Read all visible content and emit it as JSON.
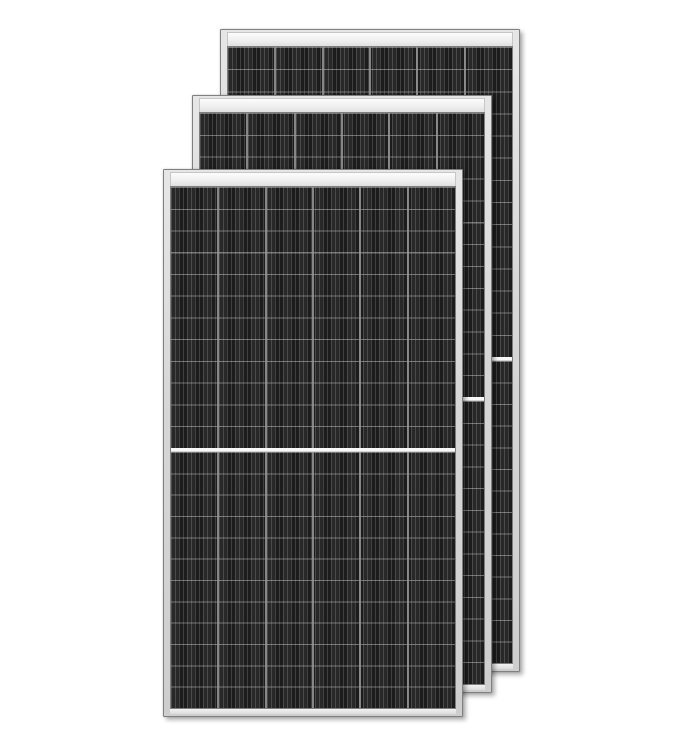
{
  "image": {
    "type": "product-photo",
    "subject": "three-framed-half-cut-solar-panels-stacked-offset",
    "text_content": "none",
    "background": "#ffffff"
  },
  "colors": {
    "bg": "#ffffff",
    "frame_fill_top": "#e6e6e6",
    "frame_fill_bottom": "#cecece",
    "frame_edge": "#808080",
    "rail_top": "#fcfcfc",
    "rail_bottom": "#e0e0e0",
    "rail_border": "#a0a0a0",
    "cell_bg": "#1c1c1c",
    "cell_finger": "#404040",
    "row_line": "rgba(235,235,235,0.40)",
    "column_divider": "#999999",
    "center_divider": "#f8f8f8",
    "shadow": "rgba(0,0,0,0.30)"
  },
  "panels": [
    {
      "name": "solar-panel-back",
      "x": 220,
      "y": 29,
      "width": 300,
      "height": 643,
      "columns": 6,
      "rows_per_half": 14,
      "center_divider_offset": 310
    },
    {
      "name": "solar-panel-middle",
      "x": 192,
      "y": 95,
      "width": 300,
      "height": 598,
      "columns": 6,
      "rows_per_half": 13,
      "center_divider_offset": 284
    },
    {
      "name": "solar-panel-front",
      "x": 163,
      "y": 169,
      "width": 300,
      "height": 548,
      "columns": 6,
      "rows_per_half": 12,
      "center_divider_offset": 261
    }
  ]
}
